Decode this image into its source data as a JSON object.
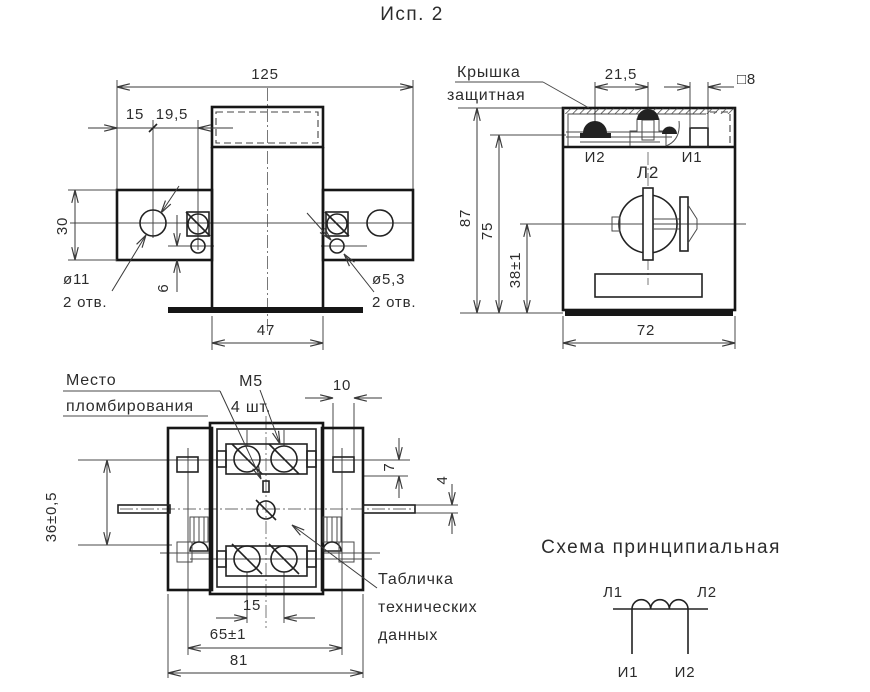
{
  "colors": {
    "background": "#ffffff",
    "ink": "#1a1a1a"
  },
  "title": "Исп. 2",
  "front_view": {
    "dim_width": "125",
    "dim_15": "15",
    "dim_19_5": "19,5",
    "dim_30": "30",
    "hole_left_dia": "ø11",
    "hole_left_qty": "2 отв.",
    "dim_6": "6",
    "hole_right_dia": "ø5,3",
    "hole_right_qty": "2 отв.",
    "dim_47": "47"
  },
  "side_view": {
    "cover_label_line1": "Крышка",
    "cover_label_line2": "защитная",
    "dim_21_5": "21,5",
    "dim_square8": "□8",
    "dim_87": "87",
    "dim_75": "75",
    "dim_38": "38±1",
    "dim_72": "72",
    "terminal_i2": "И2",
    "terminal_l2": "Л2",
    "terminal_i1": "И1"
  },
  "bottom_view": {
    "seal_label_line1": "Место",
    "seal_label_line2": "пломбирования",
    "thread_label_line1": "М5",
    "thread_label_line2": "4 шт.",
    "dim_10": "10",
    "dim_7": "7",
    "dim_4": "4",
    "dim_36": "36±0,5",
    "dim_15": "15",
    "dim_65": "65±1",
    "dim_81": "81",
    "plate_label_line1": "Табличка",
    "plate_label_line2": "технических",
    "plate_label_line3": "данных"
  },
  "schematic": {
    "title": "Схема принципиальная",
    "primary_left": "Л1",
    "primary_right": "Л2",
    "secondary_left": "И1",
    "secondary_right": "И2"
  }
}
